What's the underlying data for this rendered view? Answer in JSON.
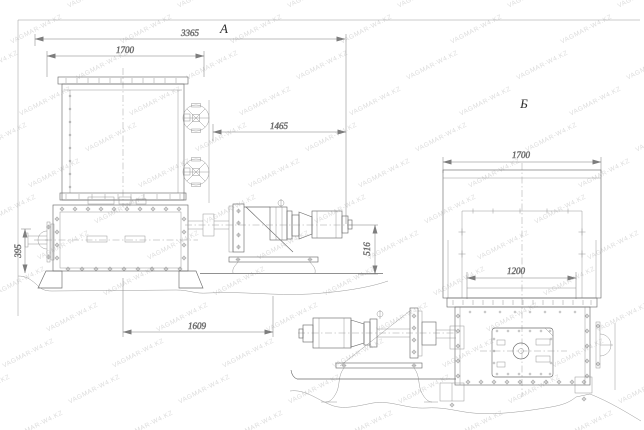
{
  "document": {
    "kind": "technical-drawing",
    "background": "#ffffff"
  },
  "colors": {
    "line": "#6d6d6d",
    "thin_line": "#8d8d8d",
    "dimension": "#7d7d7d",
    "text": "#3a3a3a",
    "watermark": "#bfbfbf"
  },
  "watermark": {
    "text": "VAGMAR-W4.KZ"
  },
  "views": {
    "a": {
      "label": "А",
      "dims": {
        "overall": "3365",
        "hopper": "1700",
        "drive": "1465",
        "height_left": "395",
        "height_drive": "516",
        "base": "1609"
      }
    },
    "b": {
      "label": "Б",
      "dims": {
        "top": "1700",
        "inner": "1200"
      }
    }
  }
}
